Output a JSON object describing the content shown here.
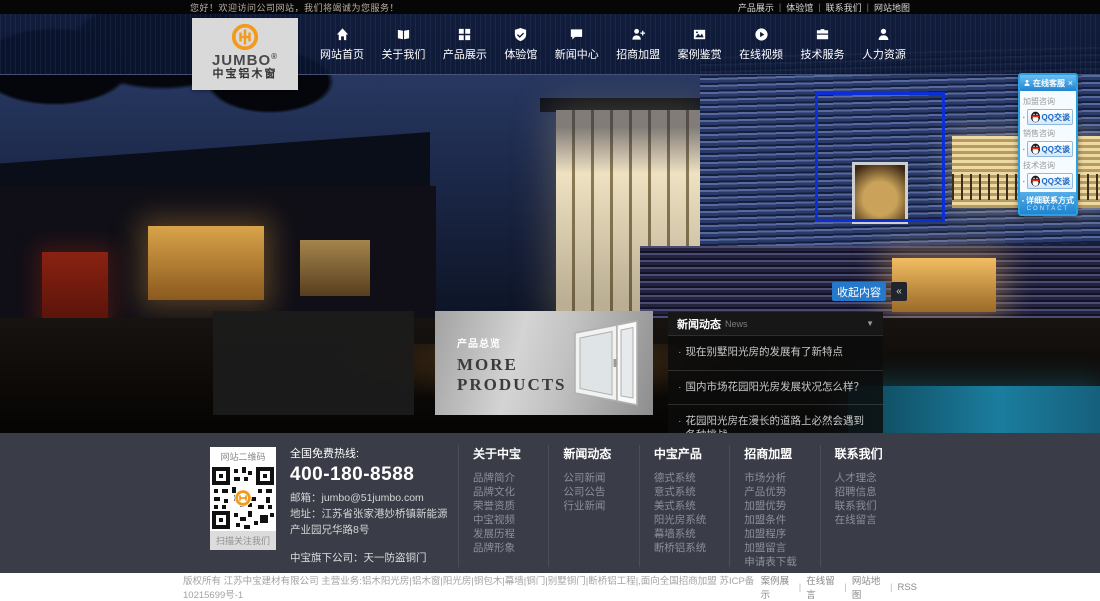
{
  "topbar": {
    "welcome": "您好！欢迎访问公司网站，我们将竭诚为您服务！",
    "separator": "|",
    "links": [
      {
        "label": "产品展示"
      },
      {
        "label": "体验馆"
      },
      {
        "label": "联系我们"
      },
      {
        "label": "网站地图"
      }
    ]
  },
  "logo": {
    "brand": "JUMBO",
    "reg": "®",
    "subtitle": "中宝铝木窗"
  },
  "nav": {
    "items": [
      {
        "label": "网站首页",
        "icon": "home-icon"
      },
      {
        "label": "关于我们",
        "icon": "book-icon"
      },
      {
        "label": "产品展示",
        "icon": "grid-icon"
      },
      {
        "label": "体验馆",
        "icon": "shield-icon"
      },
      {
        "label": "新闻中心",
        "icon": "chat-icon"
      },
      {
        "label": "招商加盟",
        "icon": "person-plus-icon"
      },
      {
        "label": "案例鉴赏",
        "icon": "photo-icon"
      },
      {
        "label": "在线视频",
        "icon": "play-icon"
      },
      {
        "label": "技术服务",
        "icon": "briefcase-icon"
      },
      {
        "label": "人力资源",
        "icon": "person-icon"
      }
    ]
  },
  "service_panel": {
    "title": "在线客服",
    "close": "×",
    "groups": [
      {
        "label": "加盟咨询",
        "button": "QQ交谈"
      },
      {
        "label": "销售咨询",
        "button": "QQ交谈"
      },
      {
        "label": "技术咨询",
        "button": "QQ交谈"
      }
    ],
    "footer": {
      "label": "详细联系方式",
      "sub": "CONTACT"
    }
  },
  "hero": {
    "collapse_label": "收起内容",
    "collapse_icon": "«"
  },
  "news_panel": {
    "title": "新闻动态",
    "subtitle": "News",
    "arrow": "▼",
    "bullet": "·",
    "items": [
      "现在别墅阳光房的发展有了新特点",
      "国内市场花园阳光房发展状况怎么样？",
      "花园阳光房在漫长的道路上必然会遇到各种挑战"
    ]
  },
  "products_panel": {
    "label": "产品总览",
    "more_line1": "MORE",
    "more_line2": "PRODUCTS"
  },
  "footer": {
    "qr": {
      "title": "网站二维码",
      "caption": "扫描关注我们"
    },
    "contact": {
      "hotline_label": "全国免费热线:",
      "phone": "400-180-8588",
      "email_line": "邮箱：jumbo@51jumbo.com",
      "address_line": "地址：江苏省张家港妙桥镇新能源产业园兄华路8号",
      "subsidiary": "中宝旗下公司：天一防盗铜门"
    },
    "columns": [
      {
        "title": "关于中宝",
        "links": [
          "品牌简介",
          "品牌文化",
          "荣誉资质",
          "中宝视频",
          "发展历程",
          "品牌形象"
        ]
      },
      {
        "title": "新闻动态",
        "links": [
          "公司新闻",
          "公司公告",
          "行业新闻"
        ]
      },
      {
        "title": "中宝产品",
        "links": [
          "德式系统",
          "意式系统",
          "美式系统",
          "阳光房系统",
          "幕墙系统",
          "断桥铝系统"
        ]
      },
      {
        "title": "招商加盟",
        "links": [
          "市场分析",
          "产品优势",
          "加盟优势",
          "加盟条件",
          "加盟程序",
          "加盟留言",
          "申请表下载"
        ]
      },
      {
        "title": "联系我们",
        "links": [
          "人才理念",
          "招聘信息",
          "联系我们",
          "在线留言"
        ]
      }
    ]
  },
  "bottombar": {
    "copyright": "版权所有 江苏中宝建材有限公司 主营业务:铝木阳光房|铝木窗|阳光房|铜包木|幕墙|铜门|别墅铜门|断桥铝工程|,面向全国招商加盟 苏ICP备10215699号-1",
    "separator": "|",
    "links": [
      {
        "label": "案例展示"
      },
      {
        "label": "在线留言"
      },
      {
        "label": "网站地图"
      },
      {
        "label": "RSS"
      }
    ]
  }
}
